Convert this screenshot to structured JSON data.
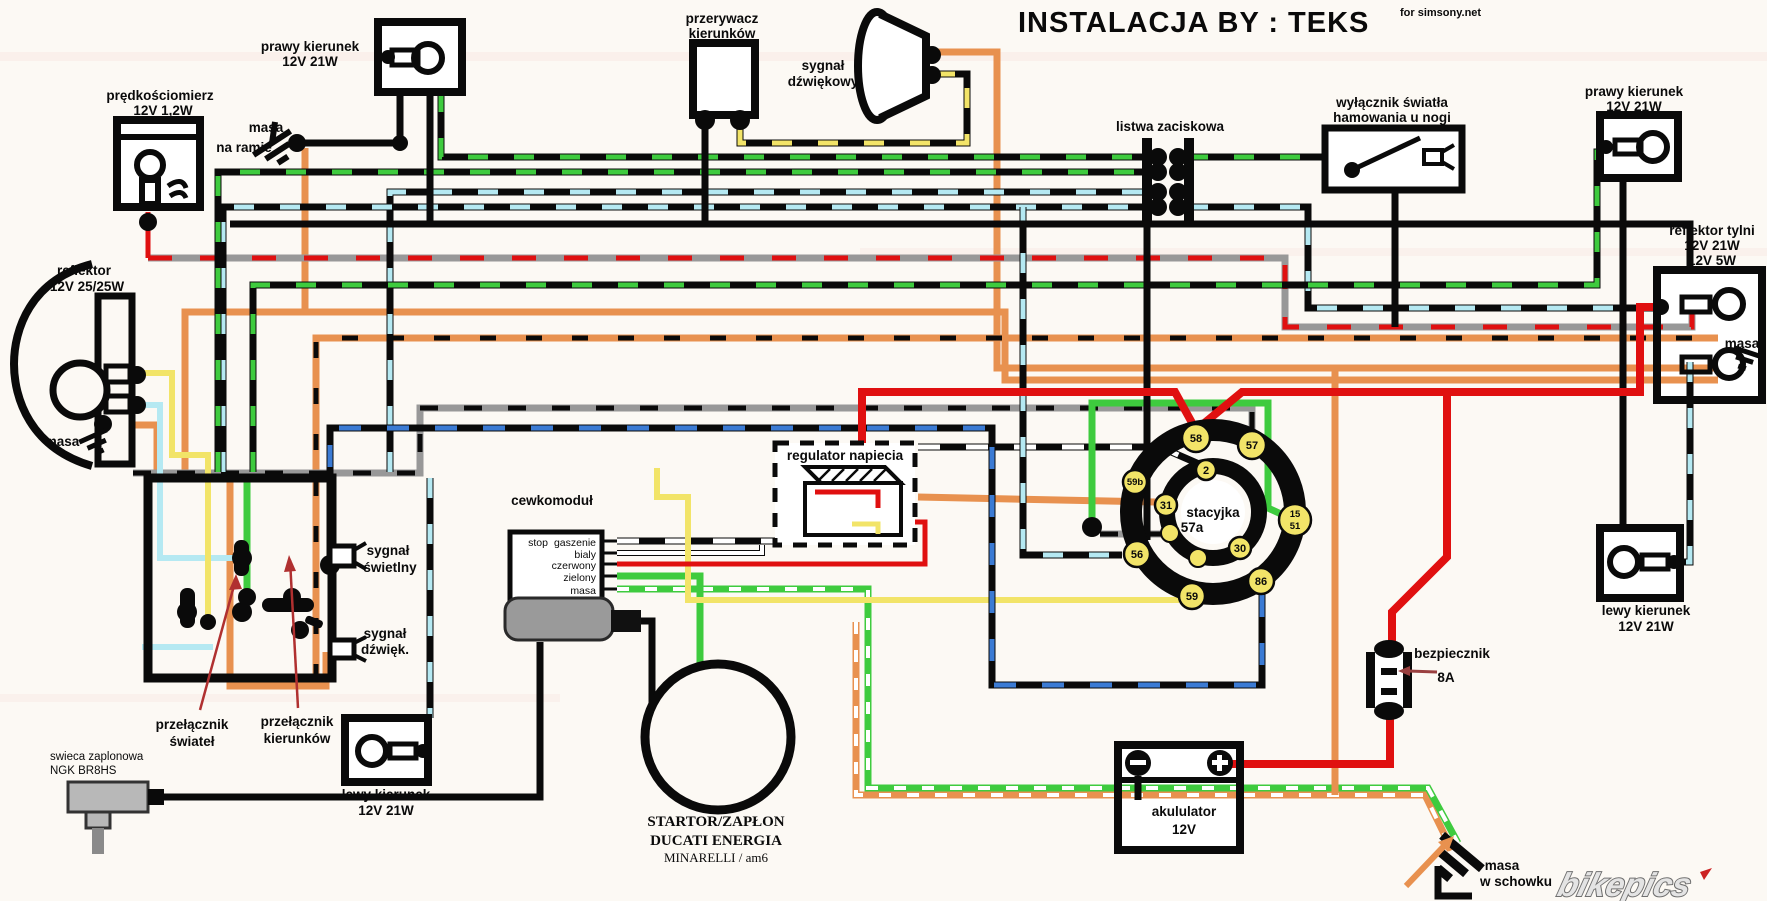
{
  "title": {
    "main": "INSTALACJA BY :  TEKS",
    "sub": "for simsony.net"
  },
  "labels": {
    "speedo1": "prędkościomierz",
    "speedo2": "12V 1,2W",
    "masa_ramie1": "masa",
    "masa_ramie2": "na ramie",
    "rturn_f1": "prawy kierunek",
    "rturn_f2": "12V 21W",
    "flasher1": "przerywacz",
    "flasher2": "kierunków",
    "horn1": "sygnał",
    "horn2": "dźwiękowy",
    "listwa": "listwa zaciskowa",
    "brake1": "wyłącznik światła",
    "brake2": "hamowania u nogi",
    "rturn_r1": "prawy kierunek",
    "rturn_r2": "12V 21W",
    "tail1": "reflektor tylni",
    "tail2": "12V 21W",
    "tail3": "12V 5W",
    "tail_masa": "masa",
    "head1": "reflektor",
    "head2": "12V 25/25W",
    "head_masa": "masa",
    "sig_sw1": "sygnał",
    "sig_sw2": "świetlny",
    "sig_dz1": "sygnał",
    "sig_dz2": "dźwięk.",
    "sw_lights1": "przełącznik",
    "sw_lights2": "świateł",
    "sw_turn1": "przełącznik",
    "sw_turn2": "kierunków",
    "plug1": "swieca zaplonowa",
    "plug2": "NGK BR8HS",
    "lturn_f1": "lewy kierunek",
    "lturn_f2": "12V 21W",
    "coil": "cewkomoduł",
    "coil_stop": "stop",
    "coil_p1": "gaszenie",
    "coil_p2": "bialy",
    "coil_p3": "czerwony",
    "coil_p4": "zielony",
    "coil_p5": "masa",
    "stator1": "STARTOR/ZAPŁON",
    "stator2": "DUCATI ENERGIA",
    "stator3": "MINARELLI / am6",
    "regulator": "regulator napiecia",
    "ign": "stacyjka",
    "ign2": "57a",
    "t58": "58",
    "t57": "57",
    "t2": "2",
    "t59b": "59b",
    "t31": "31",
    "t15": "15",
    "t51": "51",
    "t56": "56",
    "t30": "30",
    "t86": "86",
    "t59": "59",
    "fuse": "bezpiecznik",
    "fuse_a": "8A",
    "bat1": "akululator",
    "bat2": "12V",
    "lturn_r1": "lewy kierunek",
    "lturn_r2": "12V 21W",
    "masa_sch1": "masa",
    "masa_sch2": "w schowku",
    "bikepics": "bikepics"
  },
  "palette": {
    "background": "#fcf9f4",
    "black": "#0a0a0a",
    "red": "#e01010",
    "dark_red_arrow": "#9a4040",
    "orange": "#e8914f",
    "yellow": "#f2e468",
    "cyan": "#b5e9f2",
    "green": "#3ecb3e",
    "blue": "#3b7bd4",
    "gray": "#989898",
    "white": "#ffffff",
    "terminal_yellow": "#f2e468",
    "logo_gray": "#707070"
  }
}
